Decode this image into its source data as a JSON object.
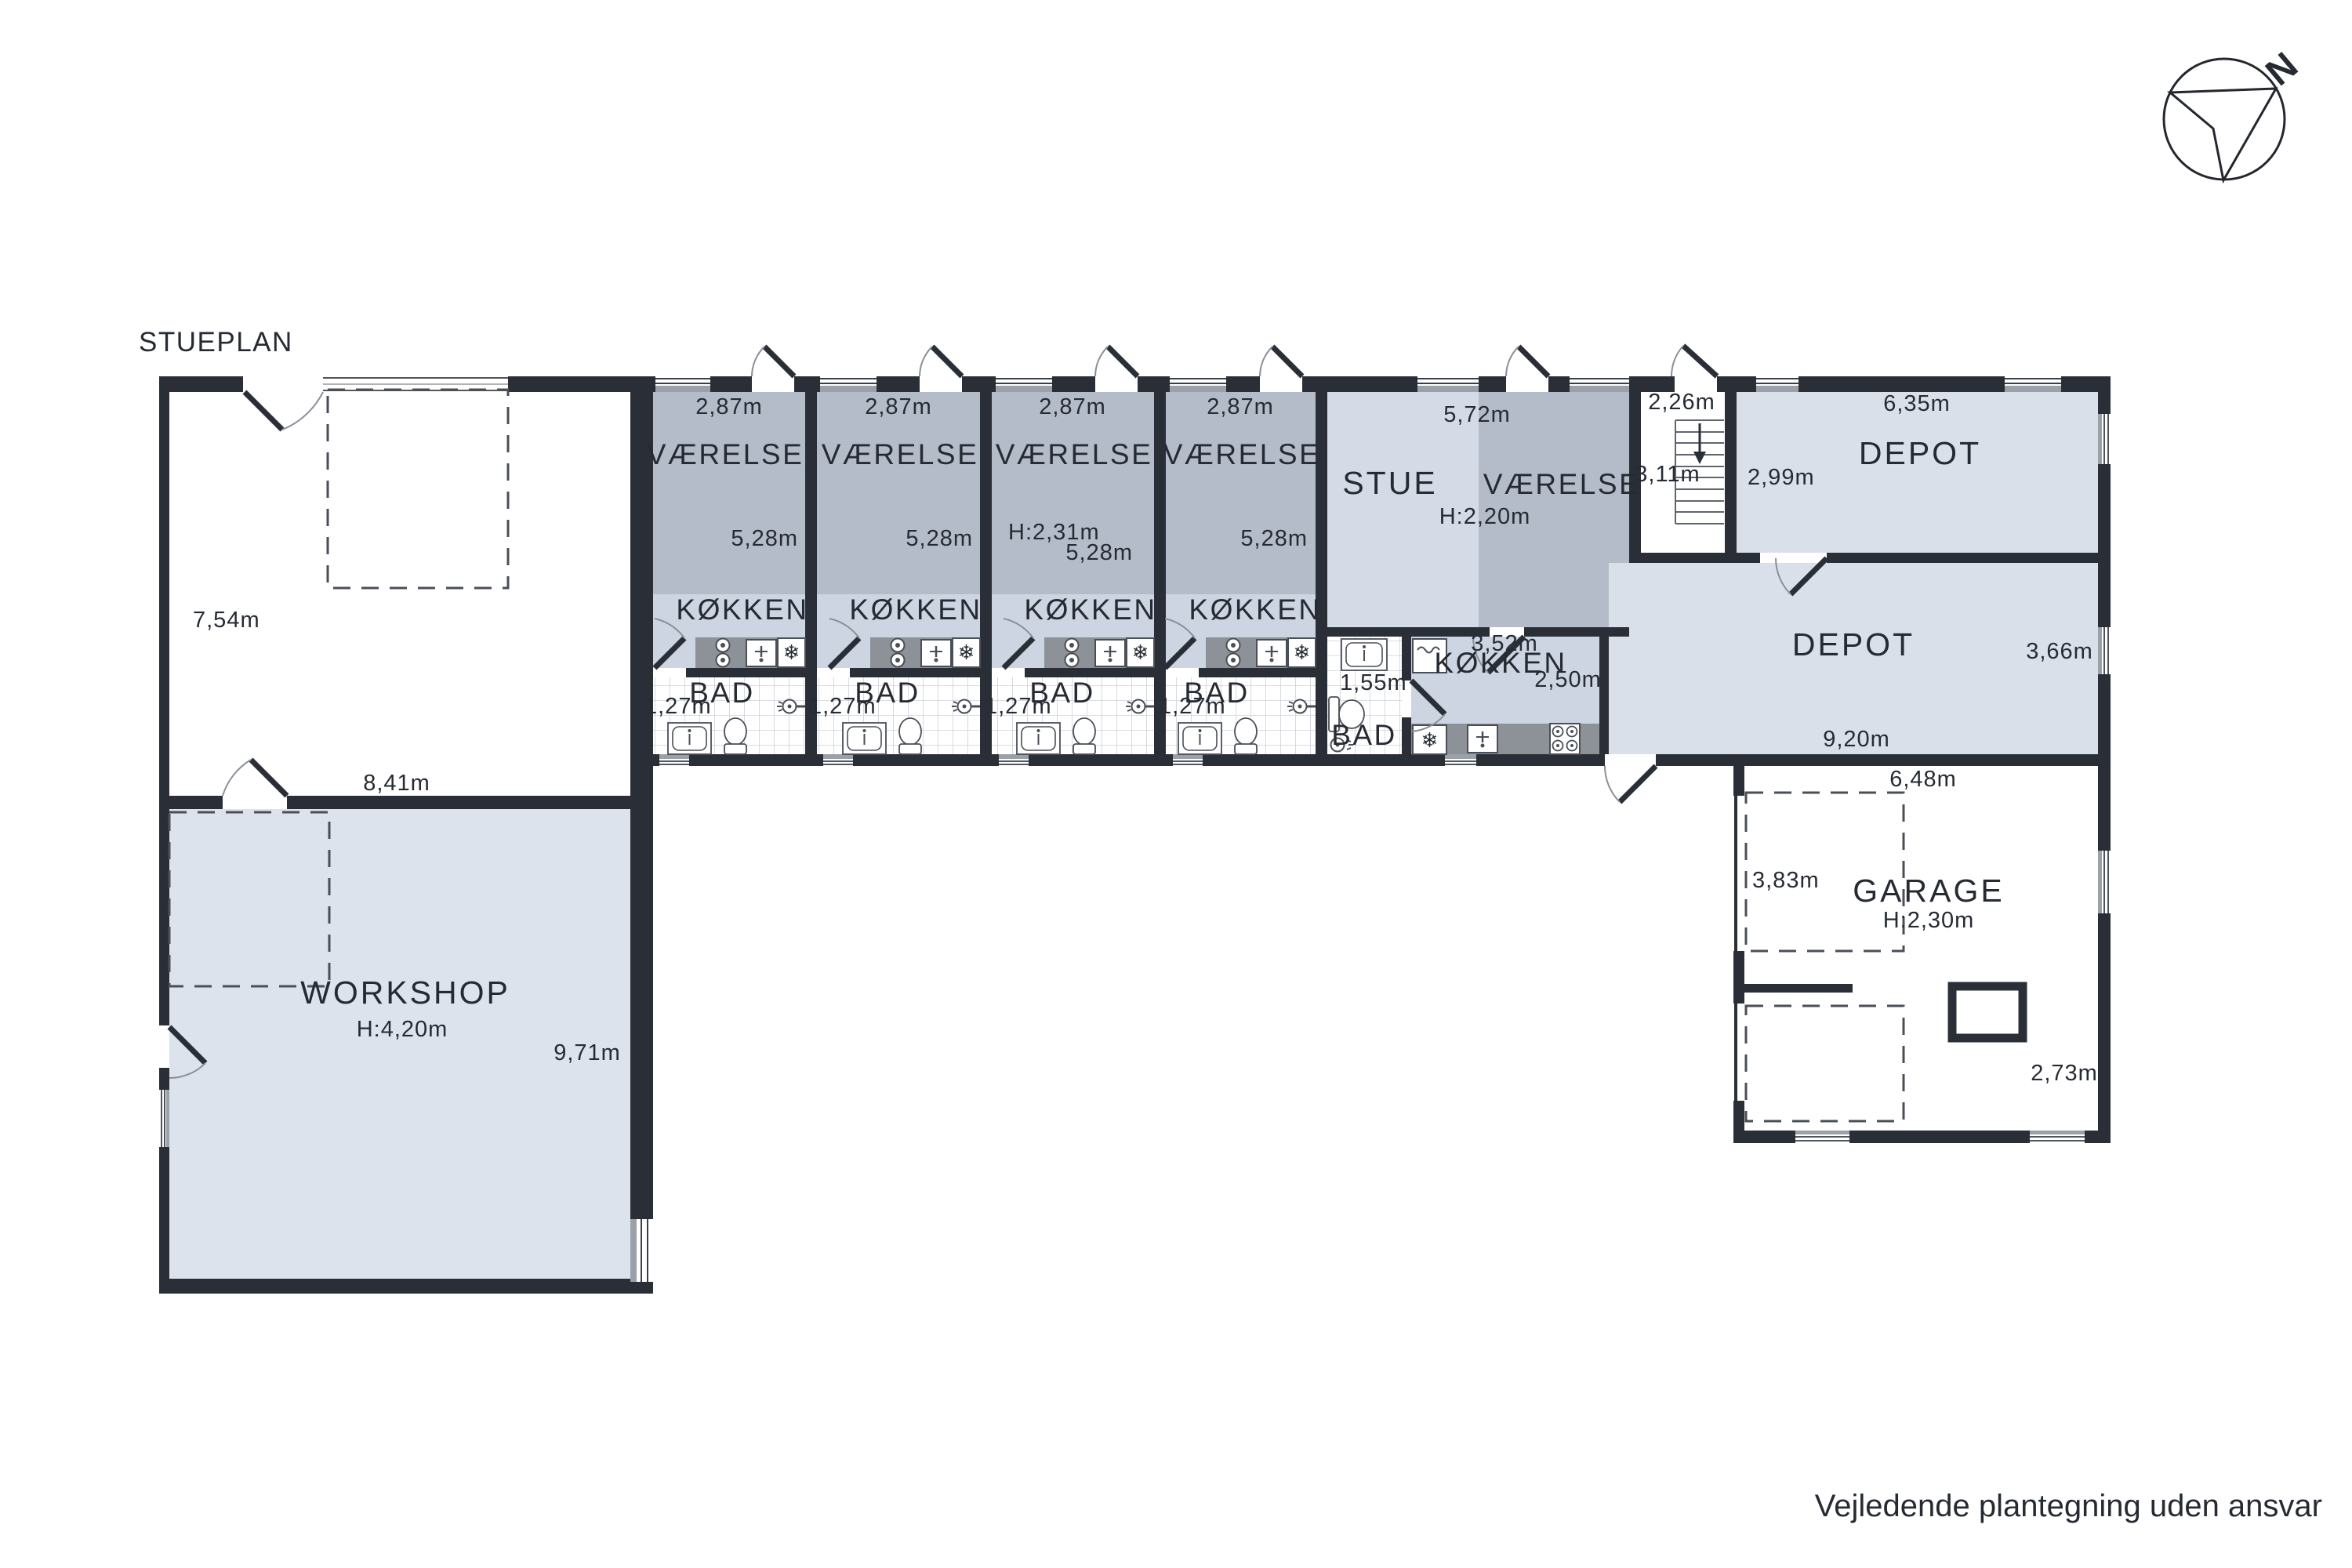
{
  "title": "STUEPLAN",
  "disclaimer": "Vejledende plantegning uden ansvar",
  "compass": {
    "north": "N"
  },
  "icons": {
    "snowflake": "❄"
  },
  "left_wing": {
    "room_height": "7,54m",
    "room_width": "8,41m",
    "workshop": {
      "label": "WORKSHOP",
      "ceiling": "H:4,20m",
      "depth": "9,71m"
    }
  },
  "units": [
    {
      "room": "VÆRELSE",
      "width": "2,87m",
      "depth": "5,28m",
      "kitchen": "KØKKEN",
      "bath": "BAD",
      "bath_width": "1,27m"
    },
    {
      "room": "VÆRELSE",
      "width": "2,87m",
      "depth": "5,28m",
      "kitchen": "KØKKEN",
      "bath": "BAD",
      "bath_width": "1,27m"
    },
    {
      "room": "VÆRELSE",
      "width": "2,87m",
      "depth": "5,28m",
      "ceiling": "H:2,31m",
      "kitchen": "KØKKEN",
      "bath": "BAD",
      "bath_width": "1,27m"
    },
    {
      "room": "VÆRELSE",
      "width": "2,87m",
      "depth": "5,28m",
      "kitchen": "KØKKEN",
      "bath": "BAD",
      "bath_width": "1,27m"
    }
  ],
  "stue_unit": {
    "living": "STUE",
    "room": "VÆRELSE",
    "width": "5,72m",
    "ceiling": "H:2,20m",
    "bath": "BAD",
    "bath_width": "1,55m",
    "kitchen": "KØKKEN",
    "kitchen_width": "3,52m",
    "kitchen_depth": "2,50m"
  },
  "stairs": {
    "width": "2,26m",
    "depth": "3,11m"
  },
  "depot_top": {
    "label": "DEPOT",
    "width": "6,35m",
    "depth": "2,99m"
  },
  "depot_bottom": {
    "label": "DEPOT",
    "depth": "3,66m",
    "width": "9,20m"
  },
  "garage": {
    "label": "GARAGE",
    "ceiling": "H:2,30m",
    "width": "6,48m",
    "depth": "3,83m",
    "width2": "2,73m"
  }
}
